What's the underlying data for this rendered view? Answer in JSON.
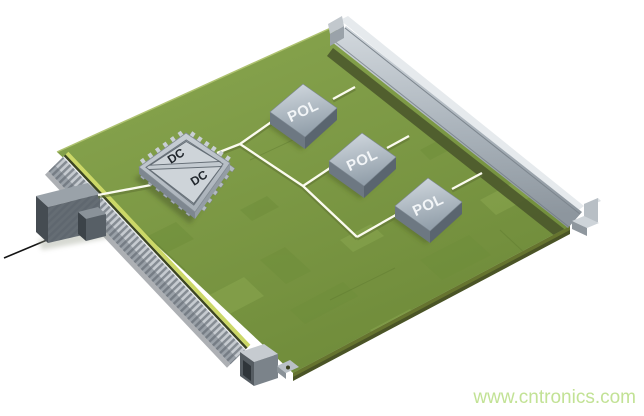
{
  "background": "#ffffff",
  "board": {
    "color_top": "#7d9a45",
    "color_edge_bright": "#ccd867",
    "color_side_dark": "#4a5426"
  },
  "components": {
    "dcdc": {
      "label_upper": "DC",
      "label_lower": "DC"
    },
    "pols": [
      {
        "label": "POL"
      },
      {
        "label": "POL"
      },
      {
        "label": "POL"
      }
    ]
  },
  "traces": {
    "color": "#fbfbef"
  },
  "watermark": {
    "text": "www.cntronics.com",
    "color": "#c2e295"
  }
}
